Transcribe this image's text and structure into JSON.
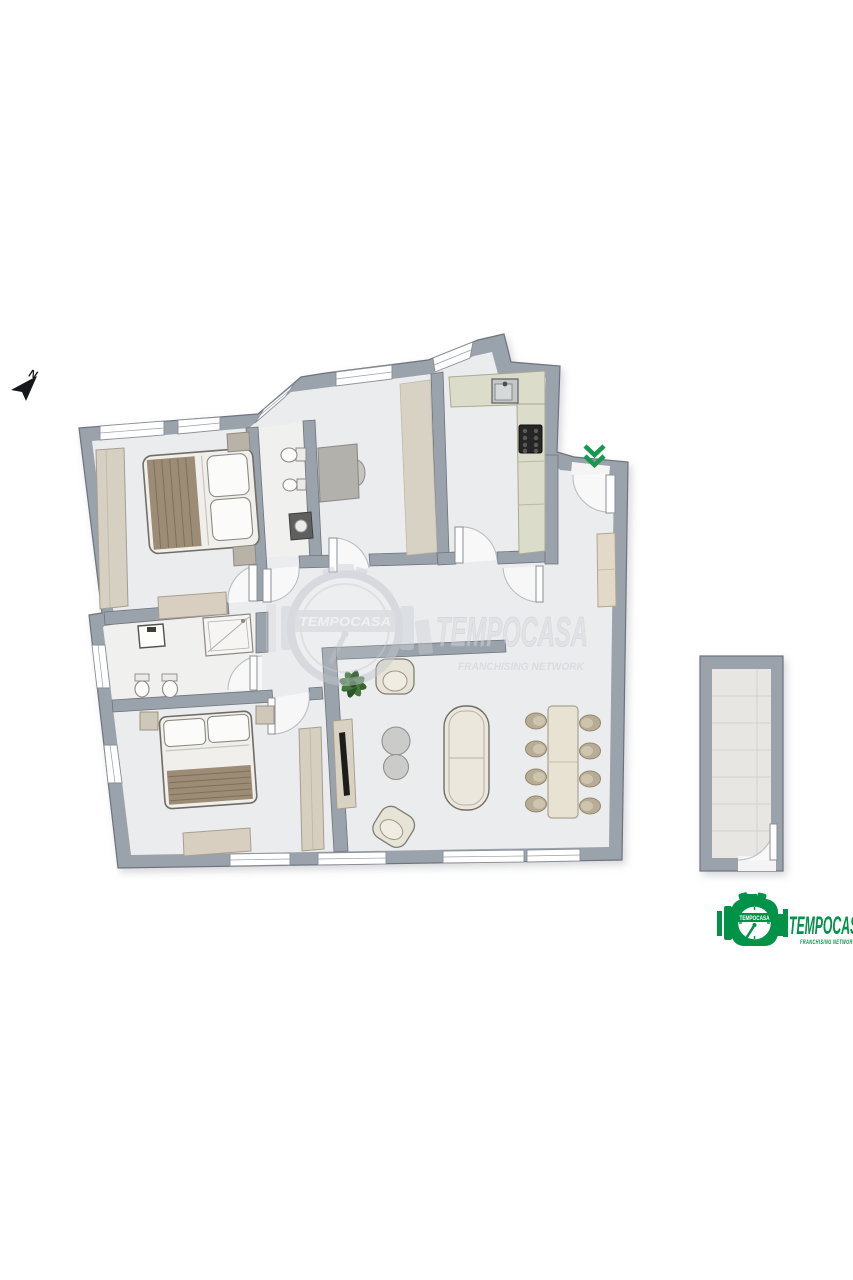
{
  "meta": {
    "alt": "Apartment floor plan with annex room"
  },
  "compass": {
    "label": "N"
  },
  "entrance_arrow": {
    "icon": "double-chevron-down",
    "color": "#17994f"
  },
  "watermark": {
    "badge_text": "TEMPOCASA",
    "brand": "TEMPOCASA",
    "tagline": "FRANCHISING NETWORK"
  },
  "logo": {
    "badge_text": "TEMPOCASA",
    "brand": "TEMPOCASA",
    "tagline": "FRANCHISING NETWORK",
    "color": "#009247"
  },
  "palette": {
    "background": "#ffffff",
    "wall": "#9aa2ab",
    "wall_outline": "#6e737b",
    "floor": "#ebecee",
    "bathroom_floor": "#f0f0ef",
    "counter": "#dcdcca",
    "furniture_beige": "#d9d2c2",
    "blanket_brown": "#9c8b75",
    "plant_green": "#3c6b38",
    "stove_black": "#262626",
    "arrow_green": "#17994f",
    "logo_green": "#009247"
  }
}
